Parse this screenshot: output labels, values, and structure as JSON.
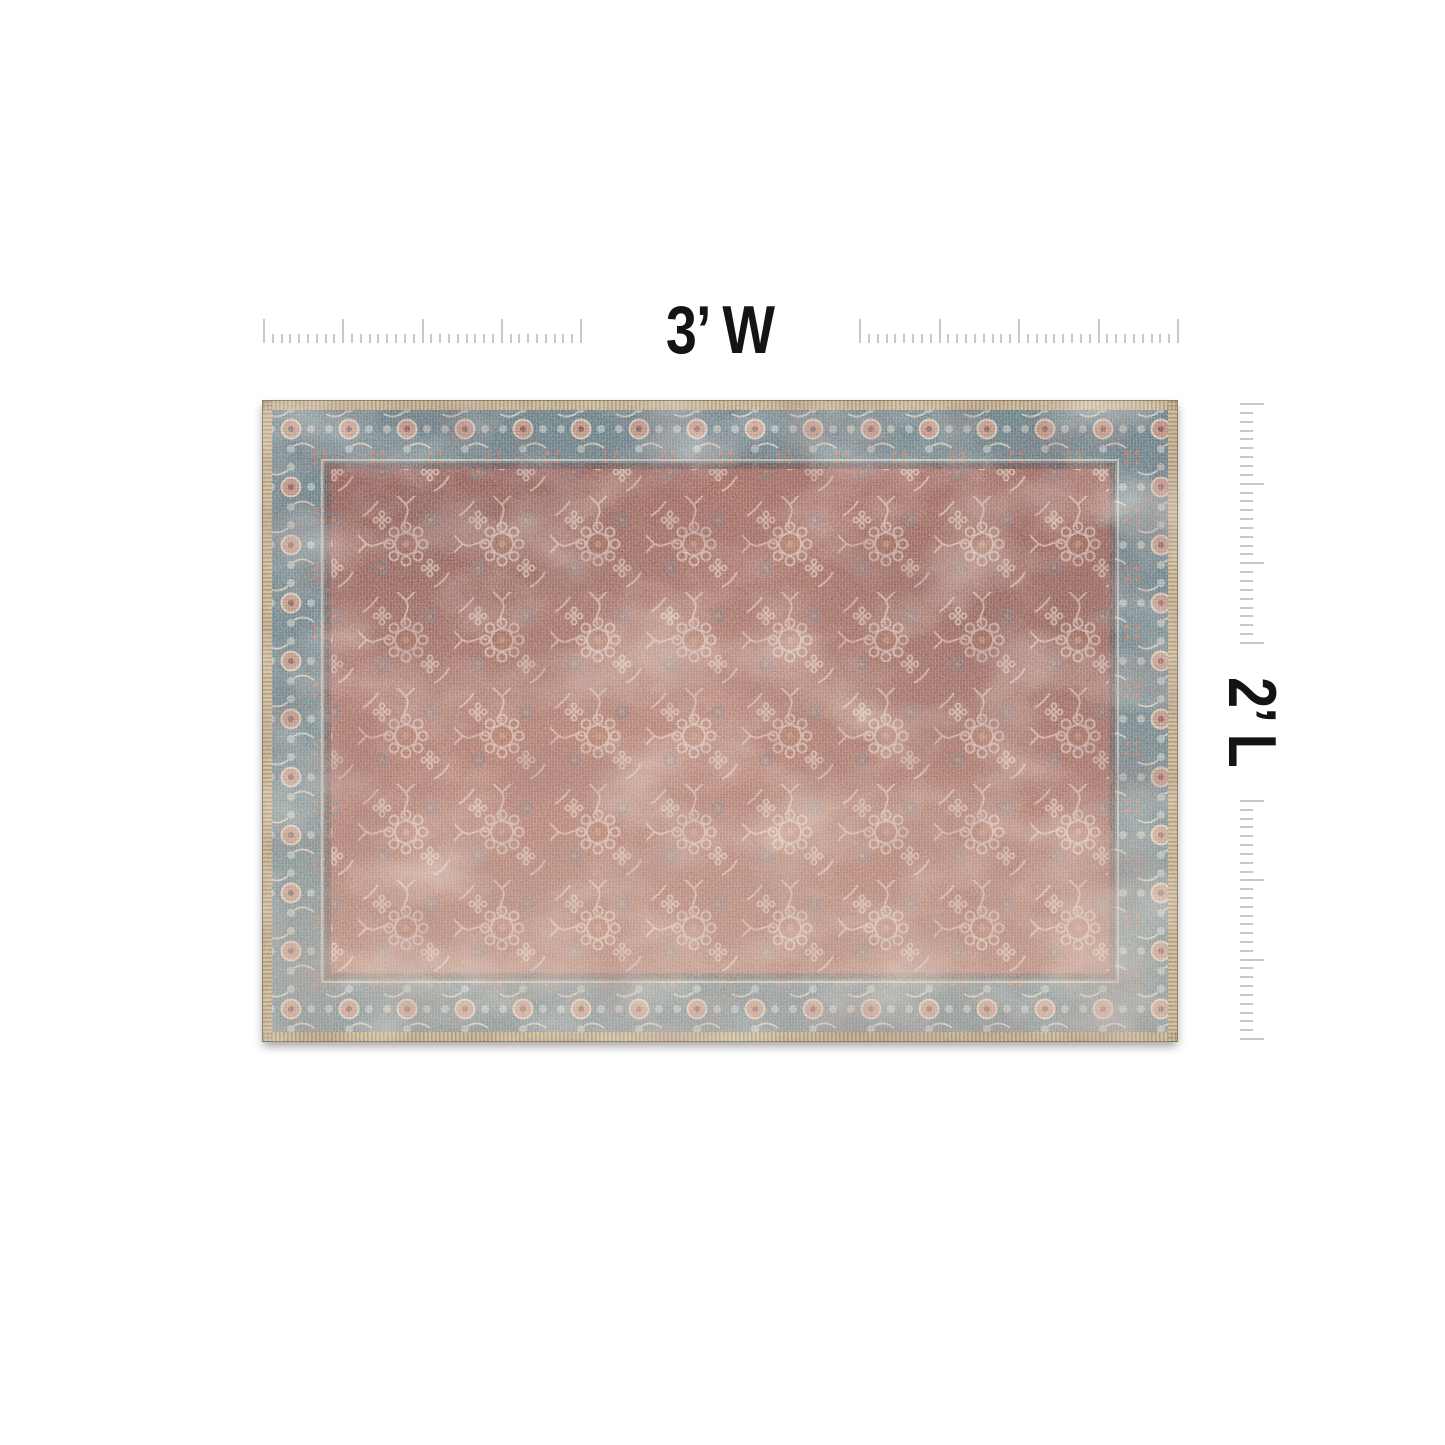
{
  "page": {
    "background_color": "#ffffff"
  },
  "dimension_labels": {
    "width": "3’ W",
    "length": "2’ L"
  },
  "rulers": {
    "tick_color": "#c9c9c9",
    "horizontal_segments": [
      {
        "ticks": 37,
        "major_every": 9
      },
      {
        "ticks": 37,
        "major_every": 9
      }
    ],
    "vertical_segments": [
      {
        "ticks": 28,
        "major_every": 9
      },
      {
        "ticks": 28,
        "major_every": 9
      }
    ]
  },
  "rug": {
    "style": "distressed vintage oriental area rug, 3 ft x 2 ft",
    "colors": {
      "binding_tan": "#c8b593",
      "border_teal": "#57747f",
      "field_brick": "#9a574d",
      "motif_cream": "#ecdccb",
      "accent_orange": "#c57c49",
      "accent_salmon": "#cf8f77",
      "accent_teal": "#4f7280",
      "guard_plum": "#5a383c"
    }
  }
}
